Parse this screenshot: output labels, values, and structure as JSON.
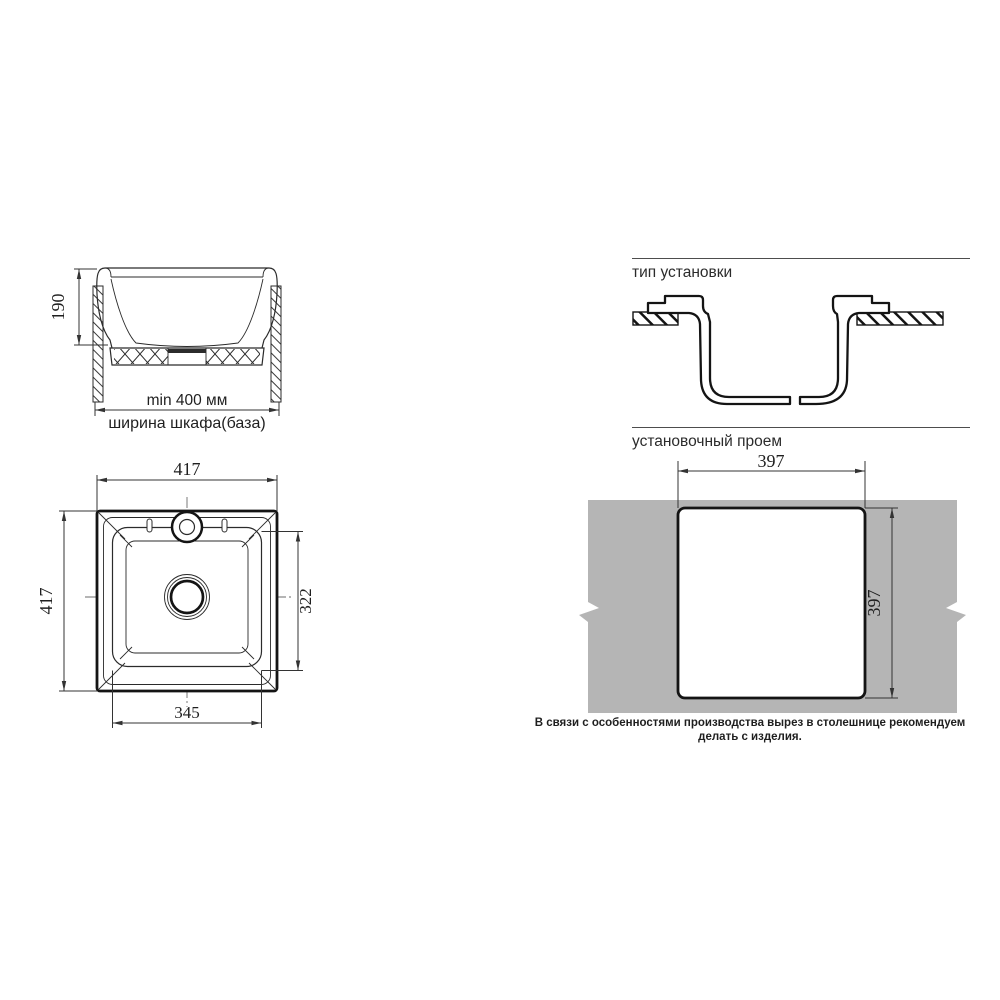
{
  "colors": {
    "countertop": "#b5b5b5",
    "line": "#1a1a1a",
    "dim": "#333333"
  },
  "section_view": {
    "depth": "190",
    "min_width": "min 400 мм",
    "cabinet": "ширина шкафа(база)"
  },
  "install_type": {
    "title": "тип установки"
  },
  "cutout": {
    "title": "установочный проем",
    "width": "397",
    "height": "397",
    "note": "В связи с особенностями производства вырез в столешнице рекомендуем делать с изделия."
  },
  "top_view": {
    "width": "417",
    "height": "417",
    "bowl_width": "345",
    "bowl_height": "322"
  }
}
